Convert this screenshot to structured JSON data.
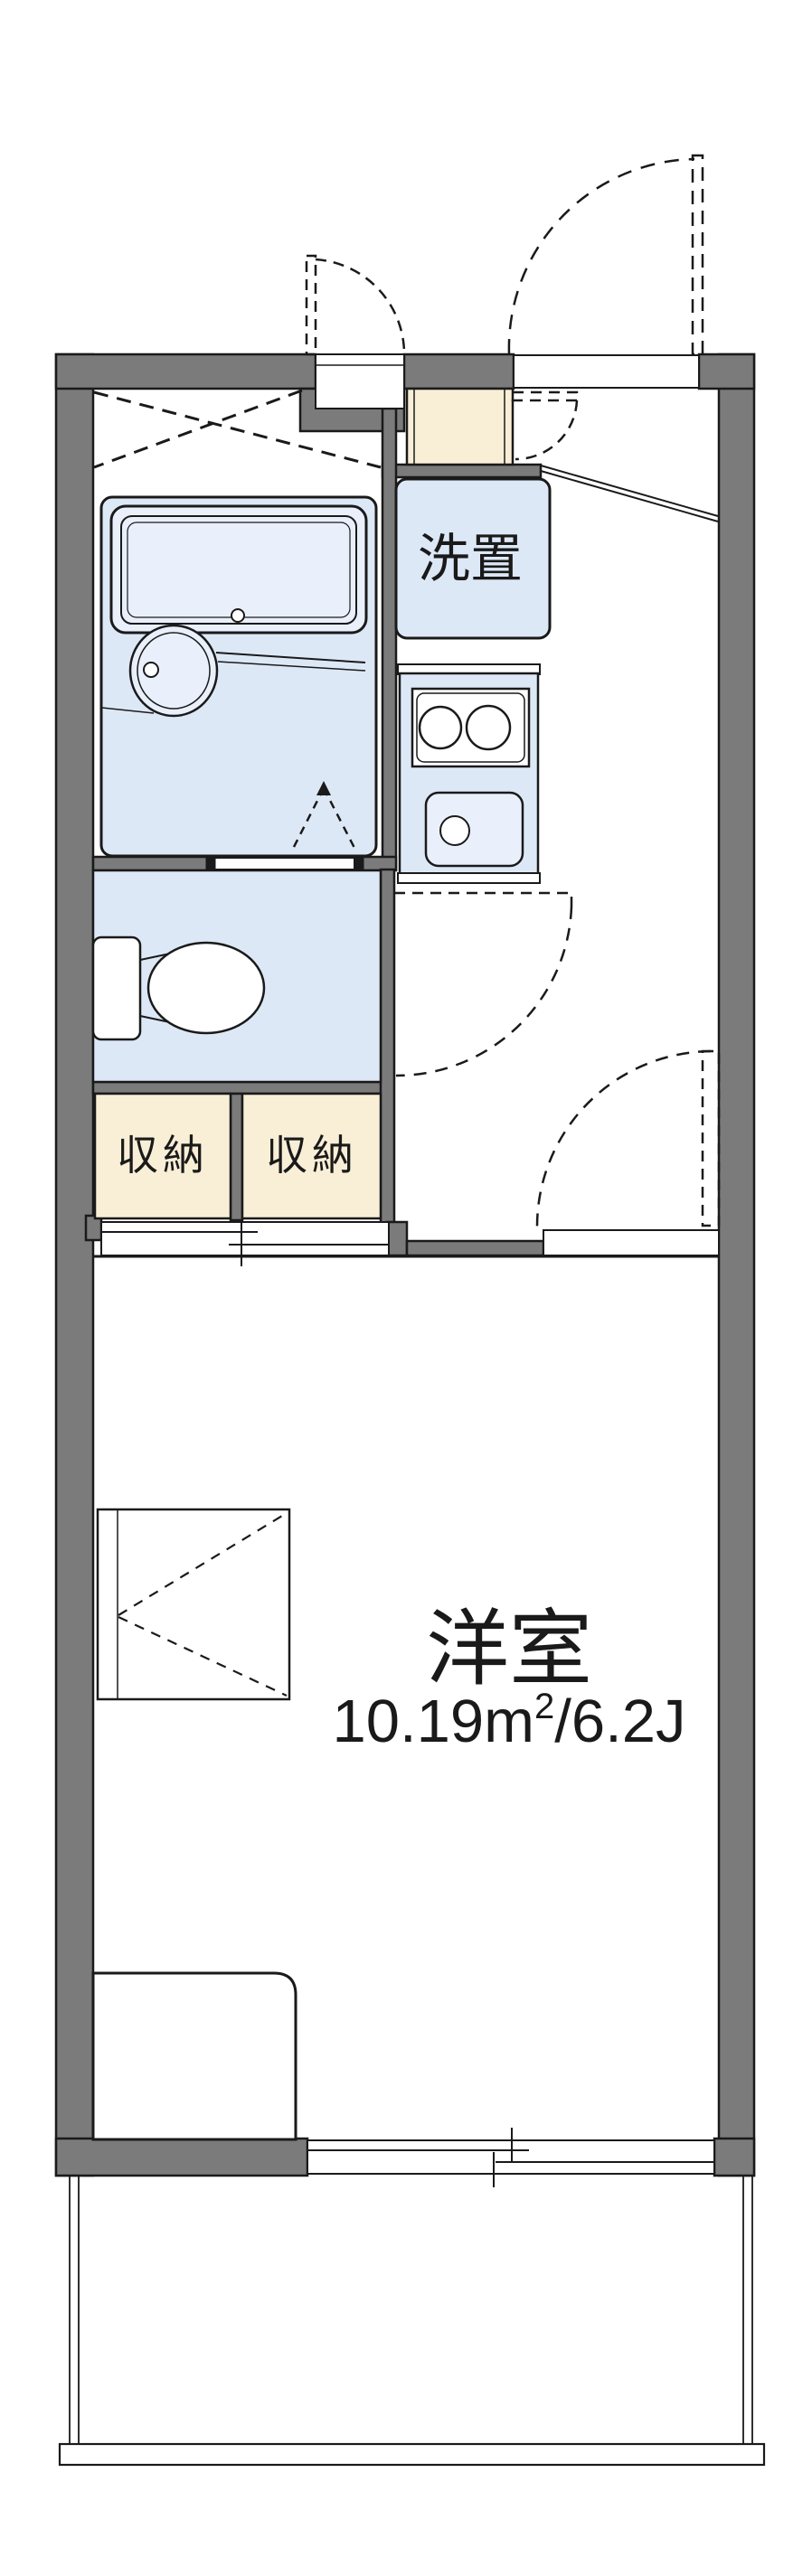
{
  "colors": {
    "bg": "#ffffff",
    "wall": "#7b7b7b",
    "line": "#1a1a1a",
    "room_fill": "#dde8f7",
    "bath_inner": "#e9f0fb",
    "cream_fill": "#f9efd7"
  },
  "rooms": {
    "washing": {
      "label": "洗置"
    },
    "storage_left": {
      "label": "収納"
    },
    "storage_right": {
      "label": "収納"
    },
    "main": {
      "label": "洋室",
      "area_value": "10.19m",
      "area_sup": "2",
      "area_rest": "/6.2J"
    }
  }
}
